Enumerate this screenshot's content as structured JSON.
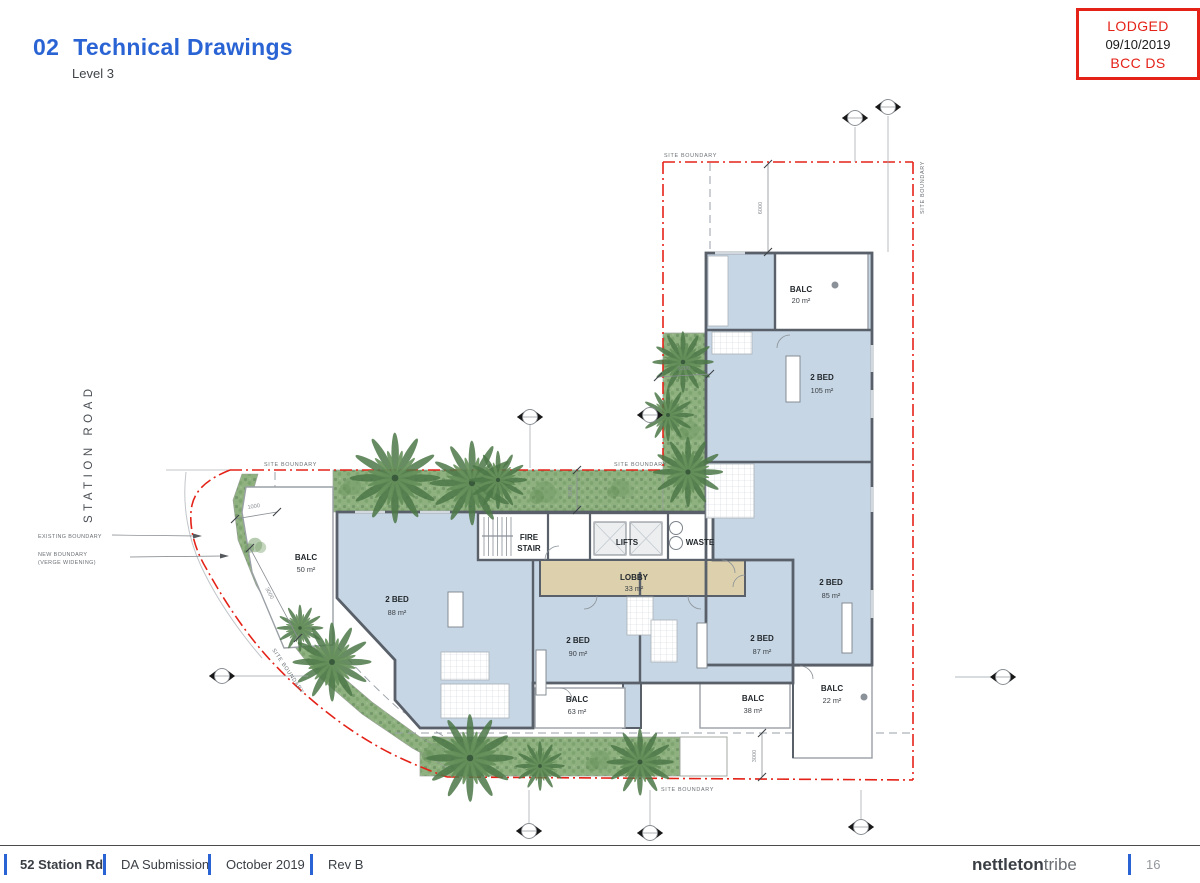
{
  "header": {
    "number": "02",
    "title": "Technical Drawings",
    "subtitle": "Level 3"
  },
  "stamp": {
    "status": "LODGED",
    "date": "09/10/2019",
    "authority": "BCC DS",
    "border_color": "#e42218"
  },
  "footer": {
    "project": "52 Station Rd",
    "submission": "DA Submission",
    "date": "October 2019",
    "revision": "Rev B",
    "firm_bold": "nettleton",
    "firm_light": "tribe",
    "page_number": "16"
  },
  "colors": {
    "accent_blue": "#2a64d4",
    "boundary_red": "#e42218",
    "unit_fill": "#c6d6e4",
    "lobby_fill": "#dcd0ad",
    "wall": "#596069",
    "vegetation": "#8fb180"
  },
  "plan": {
    "road_label": "STATION ROAD",
    "boundary": {
      "site": "SITE BOUNDARY",
      "existing": "EXISTING BOUNDARY",
      "new1": "NEW BOUNDARY",
      "new2": "(VERGE WIDENING)"
    },
    "core": {
      "fire1": "FIRE",
      "fire2": "STAIR",
      "lifts": "LIFTS",
      "waste": "WASTE",
      "lobby": "LOBBY",
      "lobby_area": "33 m²"
    },
    "units": {
      "balc20": {
        "name": "BALC",
        "area": "20 m²"
      },
      "u105": {
        "name": "2 BED",
        "area": "105 m²"
      },
      "u85": {
        "name": "2 BED",
        "area": "85 m²"
      },
      "u88": {
        "name": "2 BED",
        "area": "88 m²"
      },
      "u90": {
        "name": "2 BED",
        "area": "90 m²"
      },
      "u87": {
        "name": "2 BED",
        "area": "87 m²"
      },
      "balc50": {
        "name": "BALC",
        "area": "50 m²"
      },
      "balc63": {
        "name": "BALC",
        "area": "63 m²"
      },
      "balc38": {
        "name": "BALC",
        "area": "38 m²"
      },
      "balc22": {
        "name": "BALC",
        "area": "22 m²"
      }
    },
    "dimensions": {
      "top": "6000",
      "strip": "3200",
      "mid": "3000",
      "curve_a": "1000",
      "curve_b": "3000",
      "bottom": "3000"
    }
  }
}
